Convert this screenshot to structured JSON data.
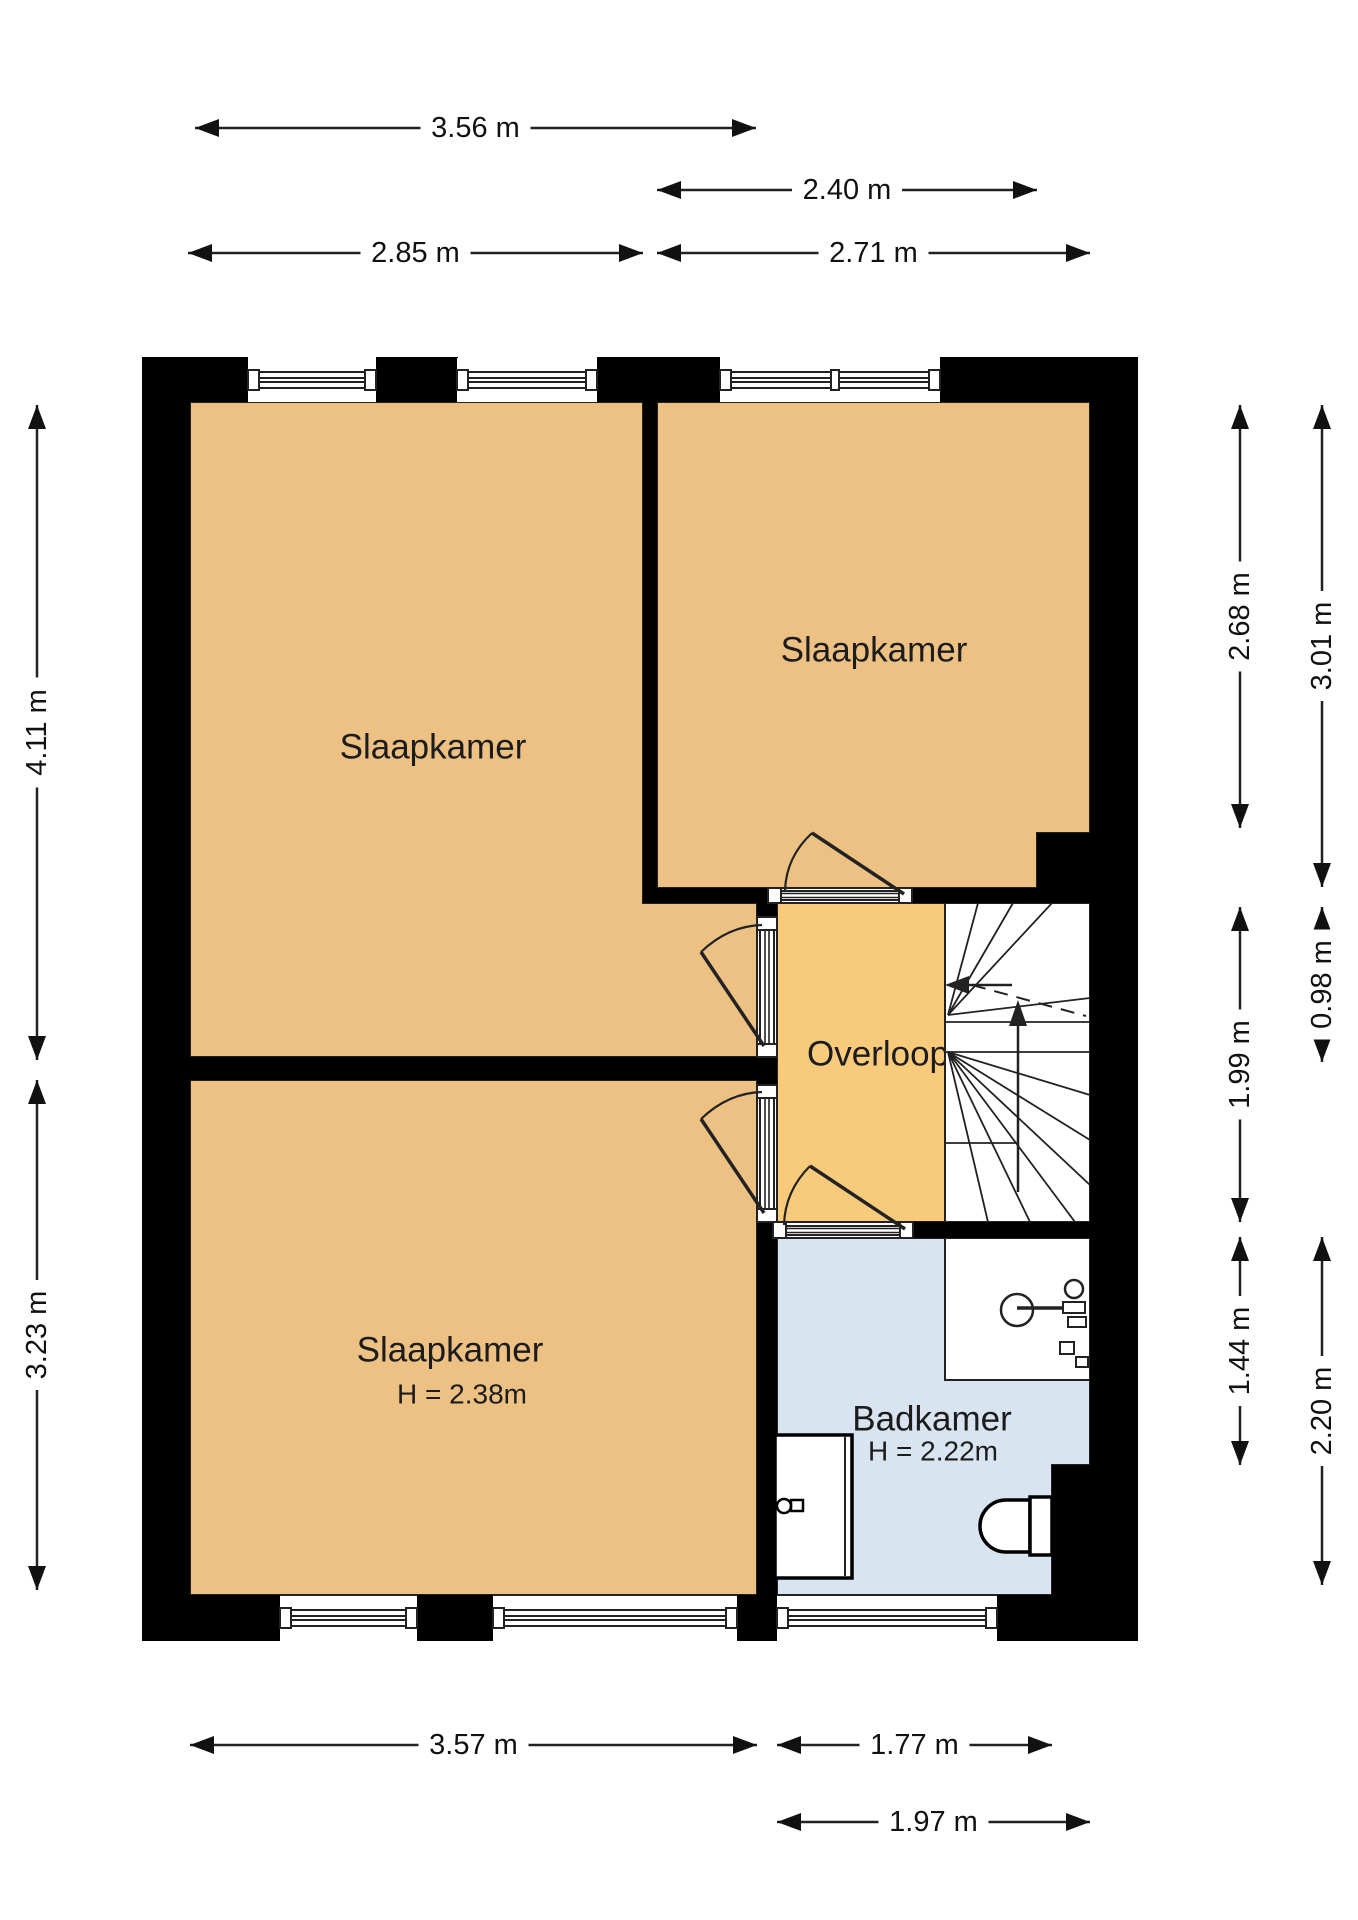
{
  "meta": {
    "type": "floorplan",
    "unit": "m",
    "canvas": [
      1358,
      1920
    ]
  },
  "colors": {
    "wall": "#000000",
    "line": "#222222",
    "dim": "#111111",
    "bedroom_floor": "#ECC183",
    "landing_floor": "#F8CA7C",
    "bathroom_floor": "#D8E4F0",
    "white_floor": "#FFFFFF"
  },
  "rooms": [
    {
      "id": "slaapkamer-1",
      "label": "Slaapkamer",
      "sublabel": "",
      "fill": "bedroom_floor",
      "label_xy": [
        433,
        747
      ],
      "sublabel_xy": [
        0,
        0
      ],
      "poly": [
        [
          190,
          402
        ],
        [
          643,
          402
        ],
        [
          643,
          903
        ],
        [
          757,
          903
        ],
        [
          757,
          1057
        ],
        [
          190,
          1057
        ]
      ]
    },
    {
      "id": "slaapkamer-2",
      "label": "Slaapkamer",
      "sublabel": "",
      "fill": "bedroom_floor",
      "label_xy": [
        874,
        650
      ],
      "sublabel_xy": [
        0,
        0
      ],
      "poly": [
        [
          657,
          402
        ],
        [
          1090,
          402
        ],
        [
          1090,
          833
        ],
        [
          1037,
          833
        ],
        [
          1037,
          888
        ],
        [
          657,
          888
        ]
      ]
    },
    {
      "id": "slaapkamer-3",
      "label": "Slaapkamer",
      "sublabel": "H = 2.38m",
      "fill": "bedroom_floor",
      "label_xy": [
        450,
        1350
      ],
      "sublabel_xy": [
        462,
        1394
      ],
      "poly": [
        [
          190,
          1080
        ],
        [
          757,
          1080
        ],
        [
          757,
          1595
        ],
        [
          190,
          1595
        ]
      ]
    },
    {
      "id": "overloop",
      "label": "Overloop",
      "sublabel": "",
      "fill": "landing_floor",
      "label_xy": [
        878,
        1054
      ],
      "sublabel_xy": [
        0,
        0
      ],
      "poly": [
        [
          777,
          903
        ],
        [
          945,
          903
        ],
        [
          945,
          1222
        ],
        [
          777,
          1222
        ]
      ]
    },
    {
      "id": "trapgat",
      "label": "",
      "sublabel": "",
      "fill": "white_floor",
      "label_xy": [
        0,
        0
      ],
      "sublabel_xy": [
        0,
        0
      ],
      "poly": [
        [
          945,
          903
        ],
        [
          1090,
          903
        ],
        [
          1090,
          1222
        ],
        [
          945,
          1222
        ]
      ]
    },
    {
      "id": "badkamer",
      "label": "Badkamer",
      "sublabel": "H = 2.22m",
      "fill": "bathroom_floor",
      "label_xy": [
        932,
        1419
      ],
      "sublabel_xy": [
        933,
        1451
      ],
      "poly": [
        [
          777,
          1238
        ],
        [
          1090,
          1238
        ],
        [
          1090,
          1465
        ],
        [
          1052,
          1465
        ],
        [
          1052,
          1595
        ],
        [
          777,
          1595
        ]
      ]
    },
    {
      "id": "wastafel-hoek",
      "label": "",
      "sublabel": "",
      "fill": "white_floor",
      "label_xy": [
        0,
        0
      ],
      "sublabel_xy": [
        0,
        0
      ],
      "poly": [
        [
          945,
          1238
        ],
        [
          1090,
          1238
        ],
        [
          1090,
          1380
        ],
        [
          945,
          1380
        ]
      ]
    }
  ],
  "walls": [
    {
      "id": "top-pier-1",
      "rect": [
        142,
        357,
        106,
        45
      ]
    },
    {
      "id": "top-pier-2",
      "rect": [
        376,
        357,
        82,
        45
      ]
    },
    {
      "id": "top-pier-3",
      "rect": [
        597,
        357,
        123,
        45
      ]
    },
    {
      "id": "top-pier-4",
      "rect": [
        940,
        357,
        198,
        45
      ]
    },
    {
      "id": "left-wall",
      "rect": [
        142,
        402,
        48,
        1239
      ]
    },
    {
      "id": "right-wall",
      "rect": [
        1090,
        402,
        48,
        1193
      ]
    },
    {
      "id": "bottom-pier-1",
      "rect": [
        142,
        1595,
        138,
        46
      ]
    },
    {
      "id": "bottom-pier-2",
      "rect": [
        417,
        1595,
        76,
        46
      ]
    },
    {
      "id": "bottom-pier-3",
      "rect": [
        737,
        1595,
        40,
        46
      ]
    },
    {
      "id": "bottom-pier-4",
      "rect": [
        997,
        1595,
        141,
        46
      ]
    },
    {
      "id": "bedroom-divider-wall",
      "rect": [
        643,
        402,
        14,
        490
      ]
    },
    {
      "id": "bedroom2-bottom-wall-a",
      "rect": [
        643,
        888,
        125,
        15
      ]
    },
    {
      "id": "bedroom2-bottom-wall-b",
      "rect": [
        912,
        888,
        178,
        15
      ]
    },
    {
      "id": "right-notch-upper",
      "rect": [
        1037,
        833,
        53,
        58
      ]
    },
    {
      "id": "landing-left-wall-a",
      "rect": [
        757,
        903,
        20,
        14
      ]
    },
    {
      "id": "landing-left-wall-b",
      "rect": [
        757,
        1057,
        20,
        28
      ]
    },
    {
      "id": "landing-left-wall-c",
      "rect": [
        757,
        1222,
        20,
        373
      ]
    },
    {
      "id": "bedroom13-divider-wall",
      "rect": [
        190,
        1057,
        567,
        23
      ]
    },
    {
      "id": "bathroom-top-wall",
      "rect": [
        913,
        1222,
        177,
        16
      ]
    },
    {
      "id": "right-notch-lower",
      "rect": [
        1052,
        1465,
        38,
        130
      ]
    }
  ],
  "windows": [
    {
      "id": "window-top-1",
      "orient": "h",
      "x1": 248,
      "x2": 376,
      "c": 380,
      "mullion": null
    },
    {
      "id": "window-top-2",
      "orient": "h",
      "x1": 457,
      "x2": 597,
      "c": 380,
      "mullion": null
    },
    {
      "id": "window-top-3",
      "orient": "h",
      "x1": 720,
      "x2": 940,
      "c": 380,
      "mullion": 831
    },
    {
      "id": "window-bottom-1",
      "orient": "h",
      "x1": 280,
      "x2": 417,
      "c": 1618,
      "mullion": null
    },
    {
      "id": "window-bottom-2",
      "orient": "h",
      "x1": 493,
      "x2": 737,
      "c": 1618,
      "mullion": null
    },
    {
      "id": "window-bottom-3",
      "orient": "h",
      "x1": 777,
      "x2": 997,
      "c": 1618,
      "mullion": null
    }
  ],
  "doors": [
    {
      "id": "door-slaapkamer-1",
      "jambs": [
        [
          757,
          917,
          20,
          13
        ],
        [
          757,
          1044,
          20,
          13
        ]
      ],
      "glass": [
        760,
        930,
        14,
        114
      ],
      "glass_dir": "v",
      "leaf": [
        [
          764,
          1046
        ],
        [
          701,
          952
        ]
      ],
      "arc": "M701,952 Q728,926 762,925"
    },
    {
      "id": "door-slaapkamer-3",
      "jambs": [
        [
          757,
          1085,
          20,
          13
        ],
        [
          757,
          1209,
          20,
          13
        ]
      ],
      "glass": [
        760,
        1098,
        14,
        111
      ],
      "glass_dir": "v",
      "leaf": [
        [
          764,
          1213
        ],
        [
          701,
          1119
        ]
      ],
      "arc": "M701,1119 Q728,1093 762,1092"
    },
    {
      "id": "door-slaapkamer-2",
      "jambs": [
        [
          768,
          888,
          13,
          15
        ],
        [
          899,
          888,
          13,
          15
        ]
      ],
      "glass": [
        781,
        891,
        118,
        9
      ],
      "glass_dir": "h",
      "leaf": [
        [
          904,
          894
        ],
        [
          812,
          833
        ]
      ],
      "arc": "M812,833 Q786,857 785,891"
    },
    {
      "id": "door-badkamer",
      "jambs": [
        [
          773,
          1222,
          13,
          16
        ],
        [
          900,
          1222,
          13,
          16
        ]
      ],
      "glass": [
        786,
        1226,
        114,
        9
      ],
      "glass_dir": "h",
      "leaf": [
        [
          905,
          1229
        ],
        [
          810,
          1166
        ]
      ],
      "arc": "M810,1166 Q785,1191 784,1225"
    }
  ],
  "stairs": {
    "border": [
      945,
      903,
      145,
      319
    ],
    "lines": [
      [
        [
          945,
          1022
        ],
        [
          1090,
          1022
        ]
      ],
      [
        [
          945,
          1052
        ],
        [
          1090,
          1052
        ]
      ],
      [
        [
          948,
          1015
        ],
        [
          978,
          903
        ]
      ],
      [
        [
          948,
          1015
        ],
        [
          1013,
          903
        ]
      ],
      [
        [
          948,
          1015
        ],
        [
          1052,
          903
        ]
      ],
      [
        [
          948,
          1015
        ],
        [
          1090,
          998
        ]
      ],
      [
        [
          948,
          1052
        ],
        [
          1090,
          1095
        ]
      ],
      [
        [
          948,
          1052
        ],
        [
          1090,
          1140
        ]
      ],
      [
        [
          948,
          1052
        ],
        [
          1090,
          1185
        ]
      ],
      [
        [
          948,
          1052
        ],
        [
          1075,
          1222
        ]
      ],
      [
        [
          948,
          1052
        ],
        [
          1030,
          1222
        ]
      ],
      [
        [
          948,
          1052
        ],
        [
          988,
          1222
        ]
      ],
      [
        [
          1018,
          1057
        ],
        [
          1018,
          1143
        ]
      ],
      [
        [
          945,
          1143
        ],
        [
          1018,
          1143
        ]
      ]
    ],
    "dashed": [
      [
        972,
        985
      ],
      [
        1086,
        1016
      ]
    ],
    "walk_arrows": [
      {
        "id": "stair-exit-arrow",
        "line": [
          [
            1012,
            985
          ],
          [
            953,
            985
          ]
        ],
        "tip": [
          945,
          985
        ],
        "dir": "left"
      },
      {
        "id": "stair-up-arrow",
        "line": [
          [
            1018,
            1192
          ],
          [
            1018,
            1012
          ]
        ],
        "tip": [
          1018,
          1000
        ],
        "dir": "up"
      }
    ]
  },
  "fixtures": {
    "sink": {
      "bowl_circle": [
        1017,
        1310,
        16
      ],
      "counter_line": [
        [
          1017,
          1308
        ],
        [
          1082,
          1308
        ]
      ],
      "faucet_circle": [
        1074,
        1289,
        9
      ],
      "faucet_rects": [
        [
          1063,
          1302,
          22,
          11
        ],
        [
          1068,
          1317,
          18,
          10
        ],
        [
          1060,
          1342,
          14,
          12
        ],
        [
          1076,
          1357,
          12,
          10
        ]
      ]
    },
    "shower_unit": {
      "outer": [
        775,
        1435,
        77,
        143
      ],
      "inner_line": [
        [
          845,
          1437
        ],
        [
          845,
          1576
        ]
      ],
      "tap_circle": [
        784,
        1506,
        7
      ],
      "tap_rect": [
        791,
        1500,
        12,
        11
      ]
    },
    "toilet": {
      "tank": [
        1030,
        1497,
        22,
        58
      ],
      "bowl_path": "M1030,1500 L1006,1500 A26,26 0 0 0 1006,1552 L1030,1552 Z"
    }
  },
  "dimensions": {
    "horizontal": [
      {
        "label": "3.56 m",
        "y": 128,
        "x1": 195,
        "x2": 756
      },
      {
        "label": "2.40 m",
        "y": 190,
        "x1": 657,
        "x2": 1037
      },
      {
        "label": "2.85 m",
        "y": 253,
        "x1": 188,
        "x2": 643
      },
      {
        "label": "2.71 m",
        "y": 253,
        "x1": 657,
        "x2": 1090
      },
      {
        "label": "3.57 m",
        "y": 1745,
        "x1": 190,
        "x2": 757
      },
      {
        "label": "1.77 m",
        "y": 1745,
        "x1": 777,
        "x2": 1052
      },
      {
        "label": "1.97 m",
        "y": 1822,
        "x1": 777,
        "x2": 1090
      }
    ],
    "vertical": [
      {
        "label": "4.11 m",
        "x": 37,
        "y1": 405,
        "y2": 1060
      },
      {
        "label": "3.23 m",
        "x": 37,
        "y1": 1080,
        "y2": 1590
      },
      {
        "label": "2.68 m",
        "x": 1240,
        "y1": 405,
        "y2": 828
      },
      {
        "label": "1.99 m",
        "x": 1240,
        "y1": 907,
        "y2": 1222
      },
      {
        "label": "1.44 m",
        "x": 1240,
        "y1": 1237,
        "y2": 1465
      },
      {
        "label": "3.01 m",
        "x": 1322,
        "y1": 405,
        "y2": 887
      },
      {
        "label": "0.98 m",
        "x": 1322,
        "y1": 907,
        "y2": 1062
      },
      {
        "label": "2.20 m",
        "x": 1322,
        "y1": 1237,
        "y2": 1585
      }
    ]
  }
}
